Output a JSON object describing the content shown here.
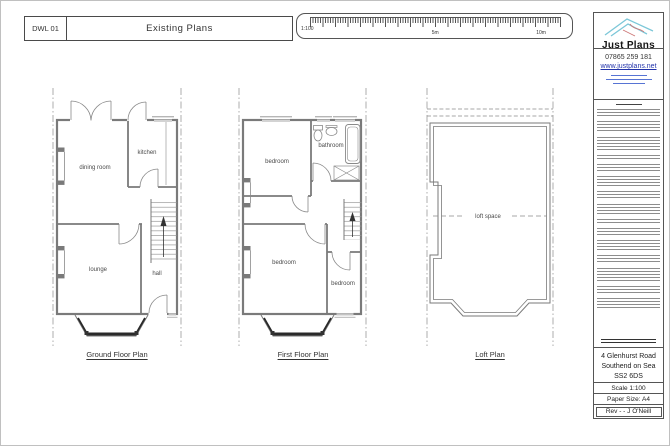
{
  "title_block": {
    "number": "DWL 01",
    "title": "Existing Plans"
  },
  "scale_bar": {
    "ratio": "1:100",
    "mid": "5m",
    "end": "10m"
  },
  "sidebar": {
    "logo_text": "Just Plans",
    "phone": "07865 259 181",
    "website": "www.justplans.net",
    "address": [
      "4 Glenhurst Road",
      "Southend on Sea",
      "SS2 6DS"
    ],
    "scale_text": "Scale 1:100",
    "paper_text": "Paper Size: A4",
    "rev_text": "Rev - - J O'Neill"
  },
  "plans": {
    "ground": {
      "title": "Ground Floor Plan",
      "rooms": {
        "dining": "dining room",
        "kitchen": "kitchen",
        "lounge": "lounge",
        "hall": "hall"
      }
    },
    "first": {
      "title": "First Floor Plan",
      "rooms": {
        "bedroom_rear": "bedroom",
        "bathroom": "bathroom",
        "bedroom_front": "bedroom",
        "bedroom_small": "bedroom"
      }
    },
    "loft": {
      "title": "Loft Plan",
      "rooms": {
        "loft": "loft space"
      }
    }
  },
  "colors": {
    "wall": "#7a7a7a",
    "detail": "#8a8a8a",
    "boundary": "#999999",
    "accent_blue": "#3a5ccc",
    "logo_cyan": "#7cc7d8",
    "logo_red": "#cc7777"
  }
}
